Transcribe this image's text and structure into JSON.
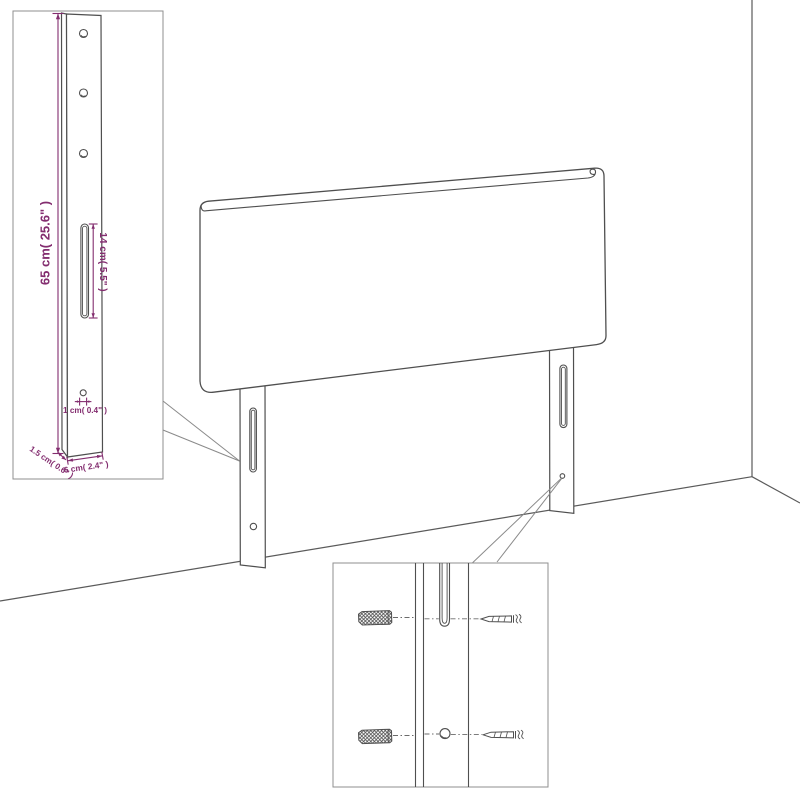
{
  "diagram": {
    "kind": "furniture-assembly-line-drawing",
    "subject": "upholstered headboard with two mounting legs shown against a wall corner",
    "colors": {
      "line": "#4f4f4f",
      "leader_line": "#8a8a8a",
      "inset_border": "#8f8f8f",
      "dimension_annotation": "#832d6f",
      "background": "#ffffff"
    },
    "labels": {
      "leg_height": "65 cm( 25.6\" )",
      "slot_length": "14 cm( 5.5\" )",
      "hole_diameter": "1 cm( 0.4\" )",
      "leg_thickness": "1.5 cm( 0.6\" )",
      "leg_width": "6 cm( 2.4\" )"
    },
    "icons": {
      "wall_plug": "wall-plug-icon",
      "screw": "screw-icon",
      "keyhole_slot": "keyhole-slot",
      "screw_hole": "screw-hole"
    }
  }
}
